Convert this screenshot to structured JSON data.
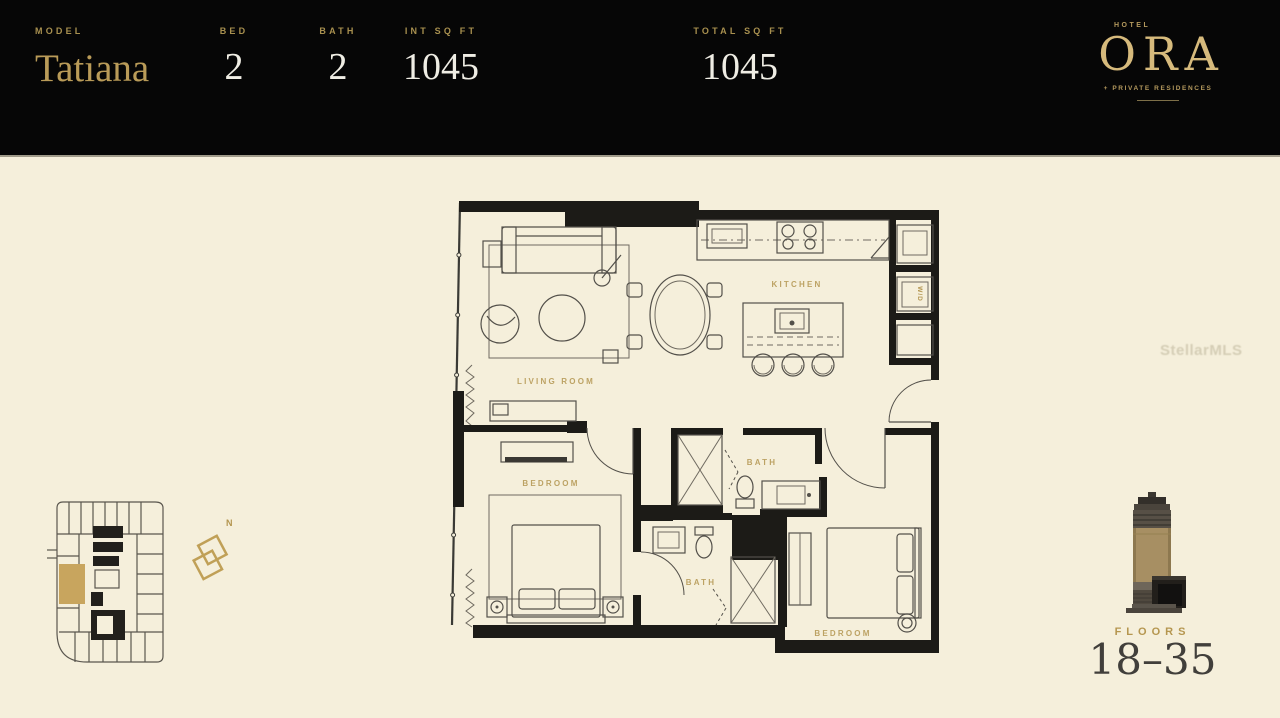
{
  "header": {
    "model_label": "MODEL",
    "model_name": "Tatiana",
    "stats": [
      {
        "label": "BED",
        "value": "2"
      },
      {
        "label": "BATH",
        "value": "2"
      },
      {
        "label": "INT SQ FT",
        "value": "1045"
      },
      {
        "label": "TOTAL SQ FT",
        "value": "1045"
      }
    ]
  },
  "logo": {
    "hotel": "HOTEL",
    "name": "ORA",
    "tagline": "+ PRIVATE RESIDENCES"
  },
  "floorplan": {
    "labels": {
      "living_room": "LIVING ROOM",
      "kitchen": "KITCHEN",
      "bedroom_left": "BEDROOM",
      "bedroom_right": "BEDROOM",
      "bath_upper": "BATH",
      "bath_lower": "BATH",
      "washer_dryer": "W/D"
    }
  },
  "keyplan": {
    "north_label": "N"
  },
  "tower": {
    "floors_label": "FLOORS",
    "floors_range": "18–35"
  },
  "watermark": "StellarMLS",
  "colors": {
    "background": "#f5efdb",
    "header_bg": "#060606",
    "gold": "#a8904f",
    "gold_bright": "#d6ba7c",
    "stat_text": "#efede4",
    "wall": "#1c1b17",
    "furniture_line": "#53504a",
    "room_label": "#b3954f",
    "keyplan_highlight": "#c8a55e",
    "tower_band": "#a78f63"
  }
}
